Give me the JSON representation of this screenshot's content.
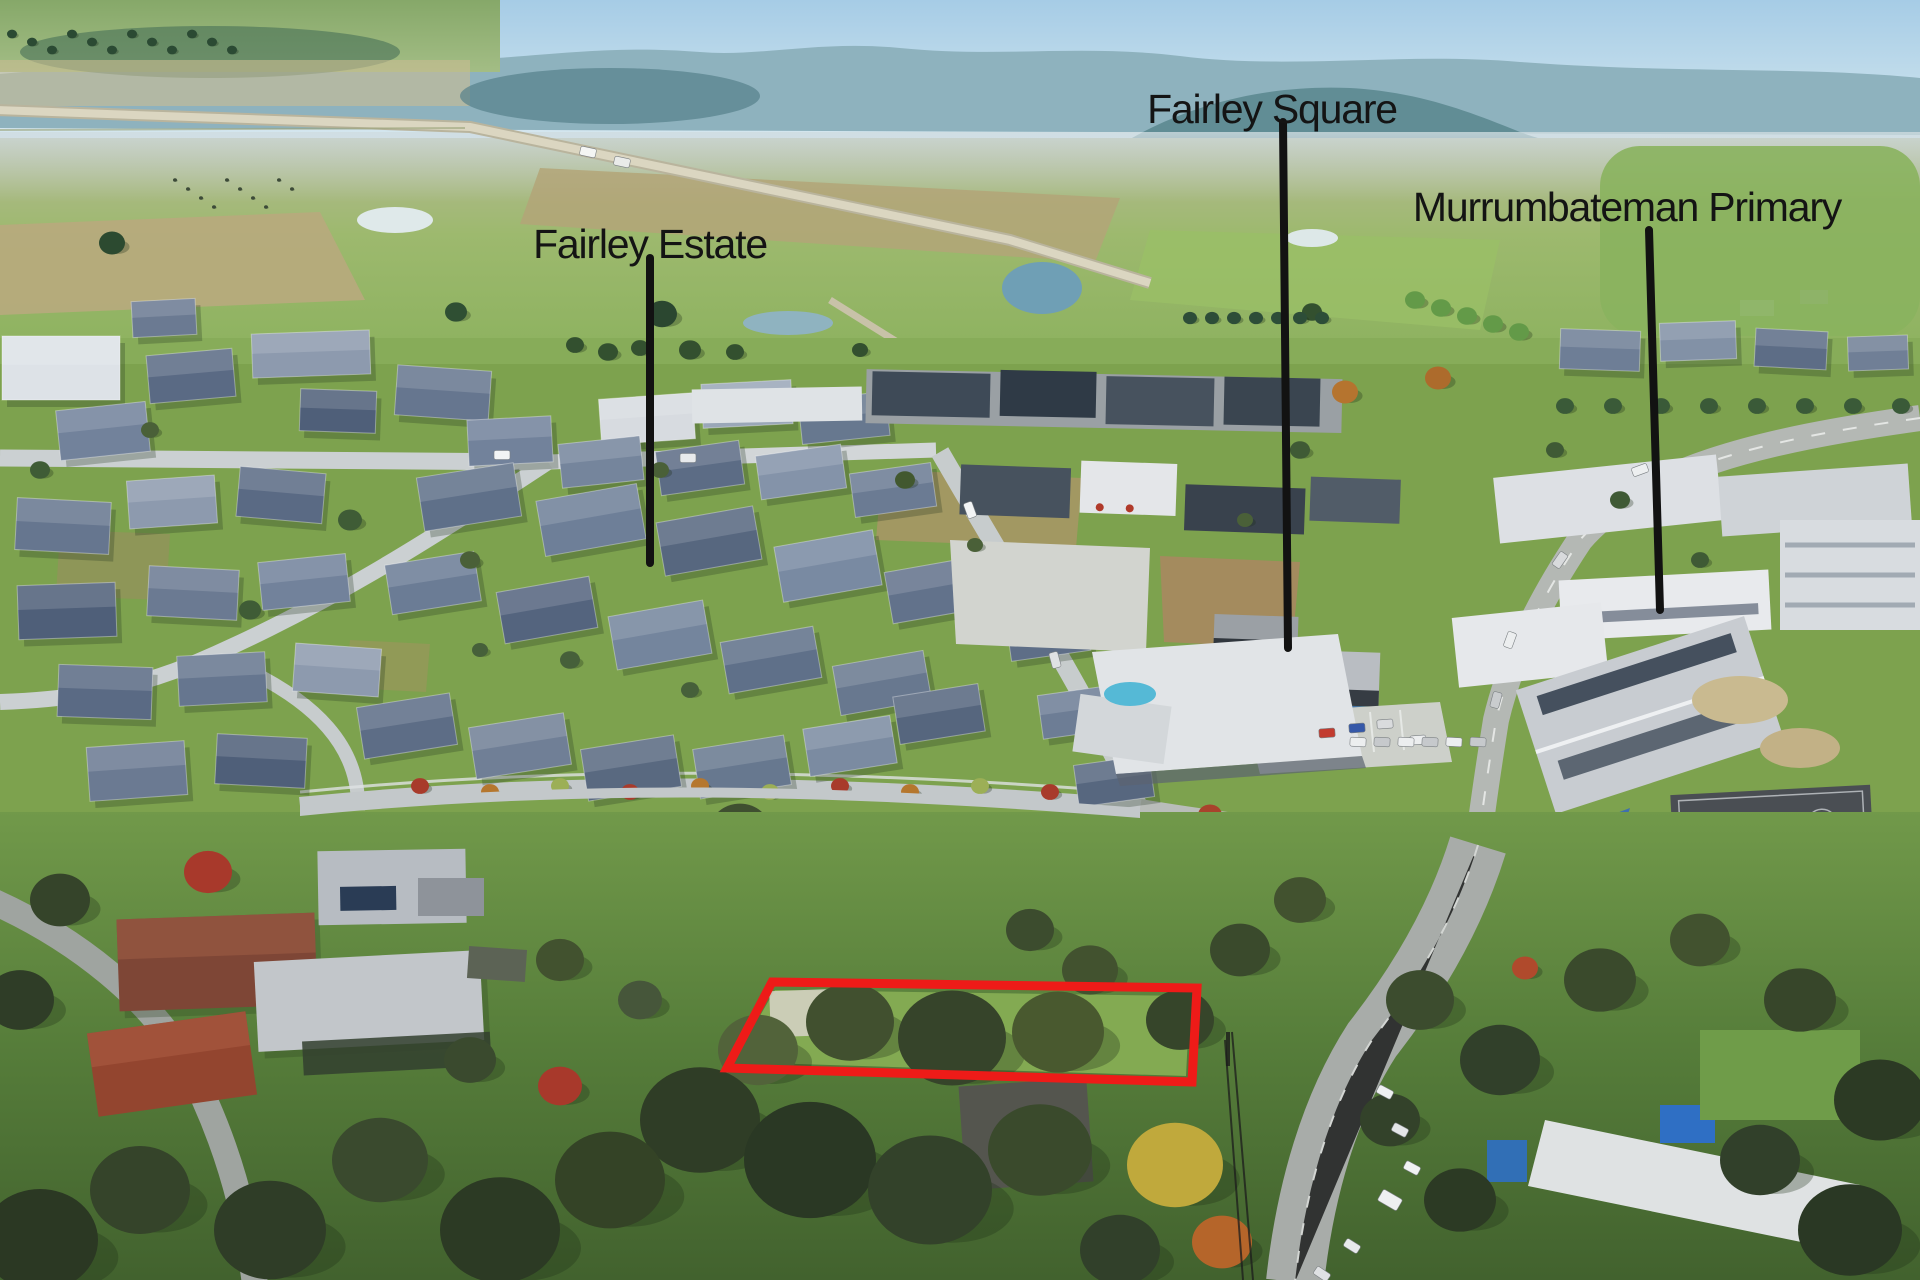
{
  "image": {
    "annotations": {
      "labels": [
        {
          "id": "fairley-estate",
          "text": "Fairley Estate"
        },
        {
          "id": "fairley-square",
          "text": "Fairley Square"
        },
        {
          "id": "murrumbateman-primary",
          "text": "Murrumbateman Primary"
        }
      ],
      "label_text_color": "#141414",
      "pointer_line_color": "#121212",
      "property_outline_color": "#ee1b18"
    }
  }
}
